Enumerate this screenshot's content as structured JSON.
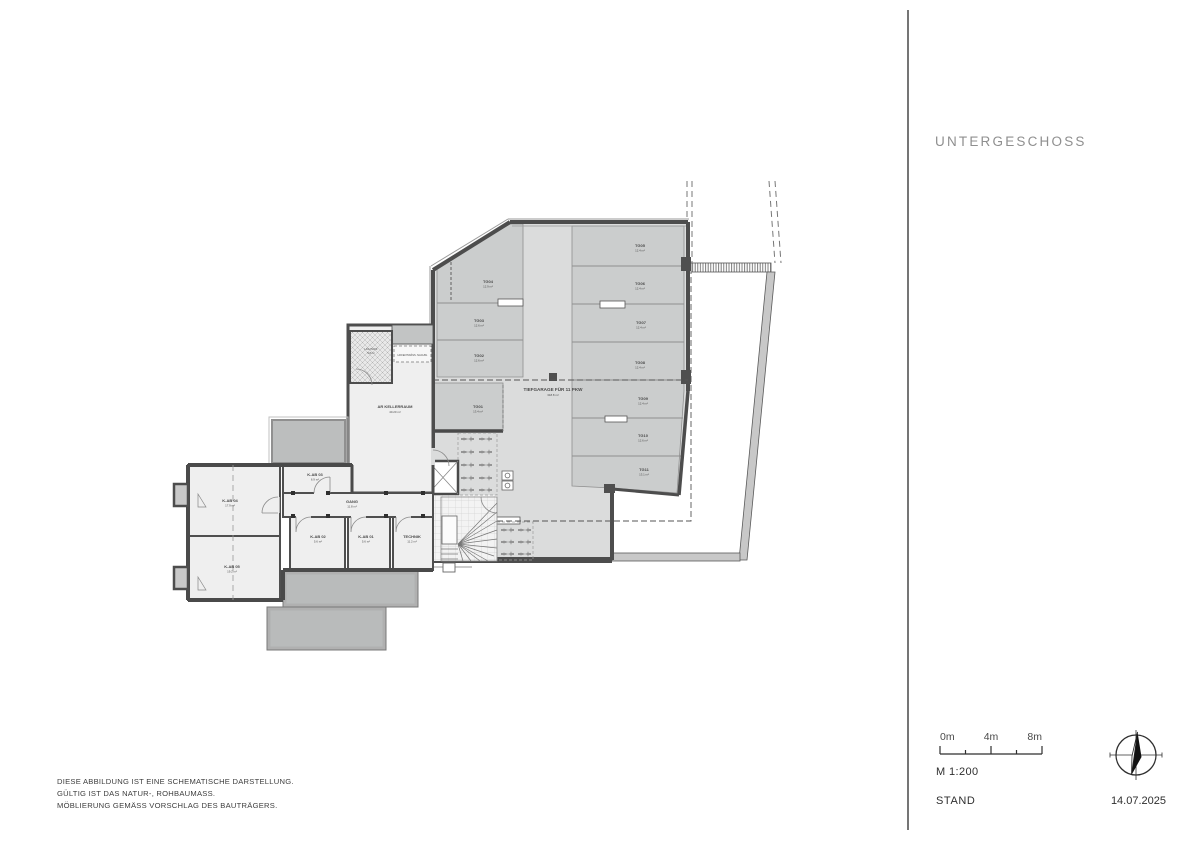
{
  "title": "UNTERGESCHOSS",
  "scalebar": {
    "tick0": "0m",
    "tick4": "4m",
    "tick8": "8m",
    "ratio": "M 1:200"
  },
  "footer": {
    "stand_label": "STAND",
    "date": "14.07.2025"
  },
  "disclaimer": {
    "line1": "DIESE ABBILDUNG IST EINE SCHEMATISCHE DARSTELLUNG.",
    "line2": "GÜLTIG IST DAS NATUR-, ROHBAUMASS.",
    "line3": "MÖBLIERUNG GEMÄSS VORSCHLAG DES BAUTRÄGERS."
  },
  "plan": {
    "garage": {
      "label": "TIEFGARAGE FÜR 11 PKW",
      "area": "318.8 m²"
    },
    "stalls": [
      {
        "id": "TG01",
        "area": "13.4 m²"
      },
      {
        "id": "TG02",
        "area": "12.6 m²"
      },
      {
        "id": "TG03",
        "area": "12.6 m²"
      },
      {
        "id": "TG04",
        "area": "12.9 m²"
      },
      {
        "id": "TG05",
        "area": "12.4 m²"
      },
      {
        "id": "TG06",
        "area": "12.4 m²"
      },
      {
        "id": "TG07",
        "area": "12.4 m²"
      },
      {
        "id": "TG08",
        "area": "12.4 m²"
      },
      {
        "id": "TG09",
        "area": "12.4 m²"
      },
      {
        "id": "TG10",
        "area": "12.6 m²"
      },
      {
        "id": "TG11",
        "area": "13.1 m²"
      }
    ],
    "rooms": {
      "kab01": {
        "name": "K-AB 01",
        "area": "5.6 m²"
      },
      "kab02": {
        "name": "K-AB 02",
        "area": "5.6 m²"
      },
      "kab03": {
        "name": "K-AB 03",
        "area": "6.9 m²"
      },
      "kab04": {
        "name": "K-AB 04",
        "area": "17.9 m²"
      },
      "kab05": {
        "name": "K-AB 05",
        "area": "19.2 m²"
      },
      "technik": {
        "name": "TECHNIK",
        "area": "11.2 m²"
      },
      "gang": {
        "name": "GANG",
        "area": "11.8 m²"
      },
      "ar": {
        "name": "AR KELLERRAUM",
        "area": "40.20 m²"
      },
      "lichthof": {
        "name": "LICHTHOF",
        "area": "5.8 m²"
      },
      "note": "HOFENTWÄSS. NACHW."
    },
    "colors": {
      "walls": "#4d4d4d",
      "garage_floor": "#dbdcdc",
      "stall_fill": "#cbcdcd",
      "room_fill": "#efefef",
      "terrace_fill": "#b9bbbb"
    }
  }
}
